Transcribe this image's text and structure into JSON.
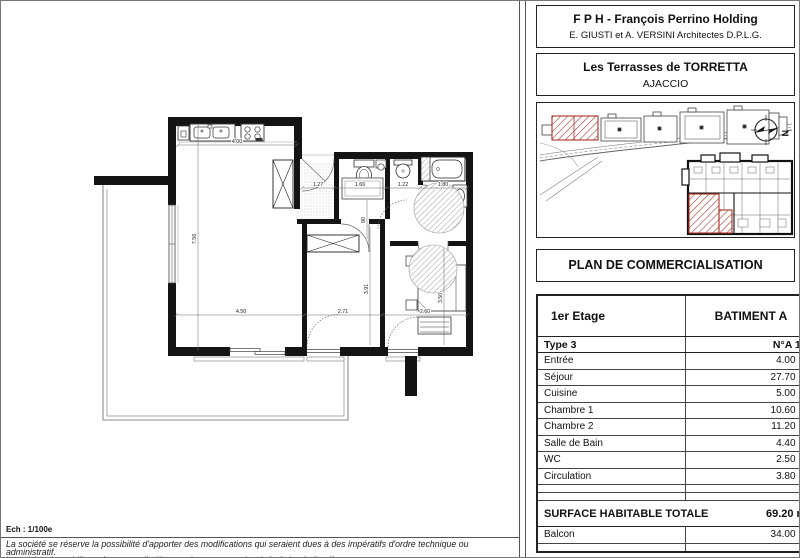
{
  "header": {
    "company": "F P H - François Perrino Holding",
    "architects": "E. GIUSTI et A. VERSINI Architectes D.P.L.G.",
    "project": "Les Terrasses de TORRETTA",
    "city": "AJACCIO"
  },
  "plan_title": "PLAN DE COMMERCIALISATION",
  "site": {
    "north": "N"
  },
  "table": {
    "floor": "1er Etage",
    "building": "BATIMENT A",
    "type": "Type 3",
    "unit": "N°A 1-1",
    "rows": [
      {
        "label": "Entrée",
        "area": "4.00 m²"
      },
      {
        "label": "Séjour",
        "area": "27.70 m²"
      },
      {
        "label": "Cuisine",
        "area": "5.00 m²"
      },
      {
        "label": "Chambre 1",
        "area": "10.60 m²"
      },
      {
        "label": "Chambre 2",
        "area": "11.20 m²"
      },
      {
        "label": "Salle de Bain",
        "area": "4.40 m²"
      },
      {
        "label": "WC",
        "area": "2.50 m²"
      },
      {
        "label": "Circulation",
        "area": "3.80 m²"
      }
    ],
    "total_label": "SURFACE HABITABLE TOTALE",
    "total_area": "69.20 m²",
    "balcony_label": "Balcon",
    "balcony_area": "34.00 m²"
  },
  "floor_plan": {
    "dims": {
      "top": "4.00",
      "left": "7.56",
      "entry": "1.27",
      "wc": "1.66",
      "shower": "1.22",
      "bath": "1.80",
      "door": "90",
      "sejour": "4.50",
      "ch1_w": "2.71",
      "ch2_w": "2.60",
      "ch1_d": "3.91",
      "ch2_d": "3.50"
    }
  },
  "footer": {
    "scale": "Ech : 1/100e",
    "line1": "La société se réserve la possibilité d'apporter des modifications qui seraient dues à des impératifs d'ordre technique ou administratif.",
    "line2": "La cuisine, le mobilier et les appareils électroménagers sont dessinés à titre indicatif."
  },
  "colors": {
    "wall": "#141414",
    "highlight_red": "#a93226"
  }
}
